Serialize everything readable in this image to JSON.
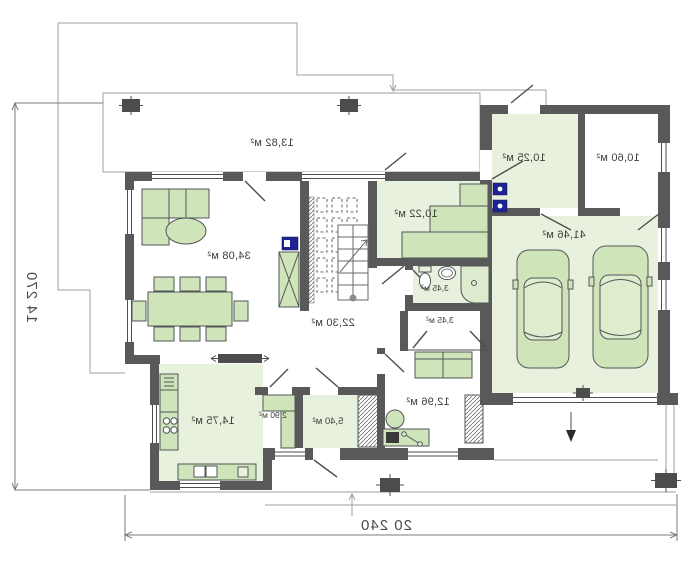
{
  "plan_title": "ground-floor-plan-mirrored",
  "dims": {
    "height": "14 270",
    "width": "20 240"
  },
  "rooms": {
    "terrace": "13,82 м²",
    "living_room": "34,08 м²",
    "wardrobe": "10,22 м²",
    "hall": "22,30 м²",
    "bathroom": "3,45 м²",
    "closet": "3,45 м²",
    "kitchen": "14,75 м²",
    "pantry": "2,90 м²",
    "vestibule": "5,40 м²",
    "office": "12,96 м²",
    "mudroom": "10,25 м²",
    "utility_room": "10,60 м²",
    "garage": "41,46 м²"
  },
  "colors": {
    "wall": "#595959",
    "floor_green": "#e8f1de",
    "furniture_green": "#cfe4b8",
    "accent_blue": "#1d2393"
  }
}
